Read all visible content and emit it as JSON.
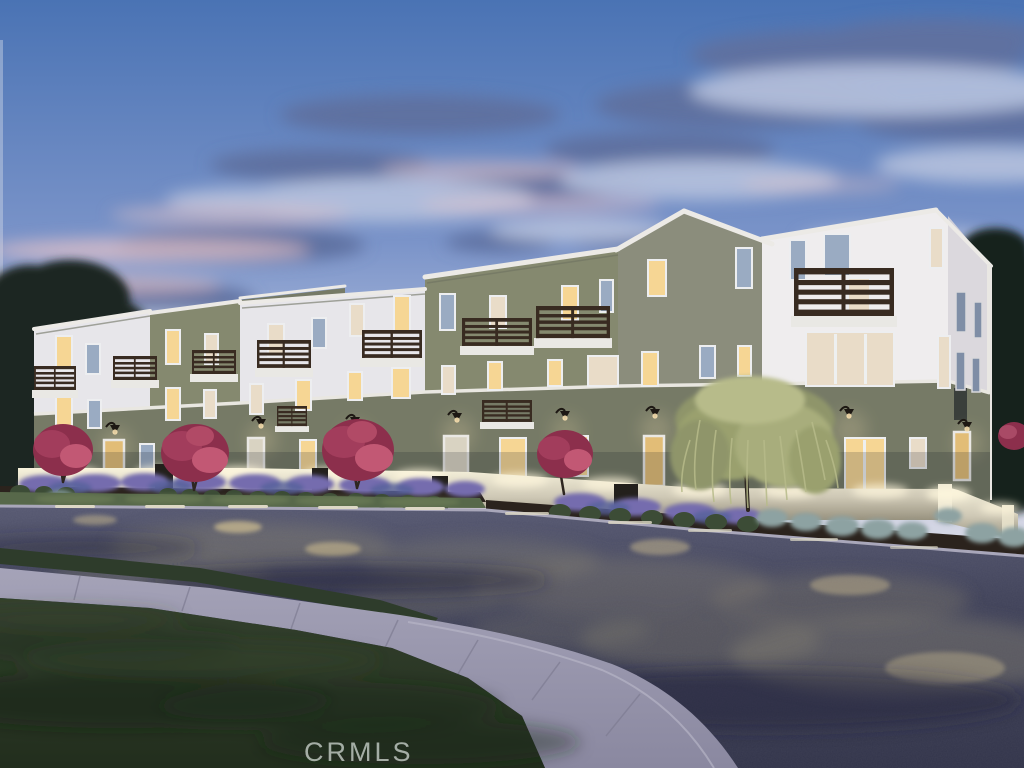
{
  "scene": {
    "type": "real-estate-photograph",
    "subject": "Modern three-story townhome building exterior rendering at dusk",
    "setting": "Curved corner street with landscaped frontage, low white garden wall, glowing windows and dark wood balcony railings",
    "time_of_day": "dusk"
  },
  "watermark": {
    "text": "CRMLS"
  },
  "palette": {
    "sky_top": "#4a73b4",
    "sky_mid": "#7b94c9",
    "sky_low": "#bfc8e2",
    "sky_horizon": "#e3dce3",
    "cloud_shadow": "#5f71a0",
    "cloud_light": "#b6c1dd",
    "cloud_pink": "#eac5c7",
    "facade_white": "#e7e6ea",
    "facade_white_bright": "#efedee",
    "facade_side": "#d8d5da",
    "facade_sage": "#85896f",
    "facade_sage_dark": "#767a66",
    "facade_gable_sage": "#8b8d7c",
    "trim_white": "#eceae6",
    "railing_brown": "#382b21",
    "window_lit": "#f6d694",
    "window_dim": "#e9dcc8",
    "window_dark": "#9aabc2",
    "door_tan": "#e2bd77",
    "garden_wall_lit": "#f7f2dc",
    "garden_wall": "#cfc9b6",
    "lavender_purple": "#756cae",
    "crape_myrtle_magenta": "#a23d5c",
    "willow_green": "#abb07e",
    "shrub_green": "#3c4c36",
    "fescue_blue_gray": "#8da2a2",
    "mulch_brown": "#2b231d",
    "street_asphalt": "#41435a",
    "street_light_glow": "#8d8875",
    "sidewalk_concrete": "#9b99af",
    "median_grass": "#2e3c2b",
    "parkway_grass": "#57684a",
    "lawn_green": "#2b3828",
    "tree_silhouette": "#1c2720",
    "watermark_color": "#c2cac3"
  }
}
